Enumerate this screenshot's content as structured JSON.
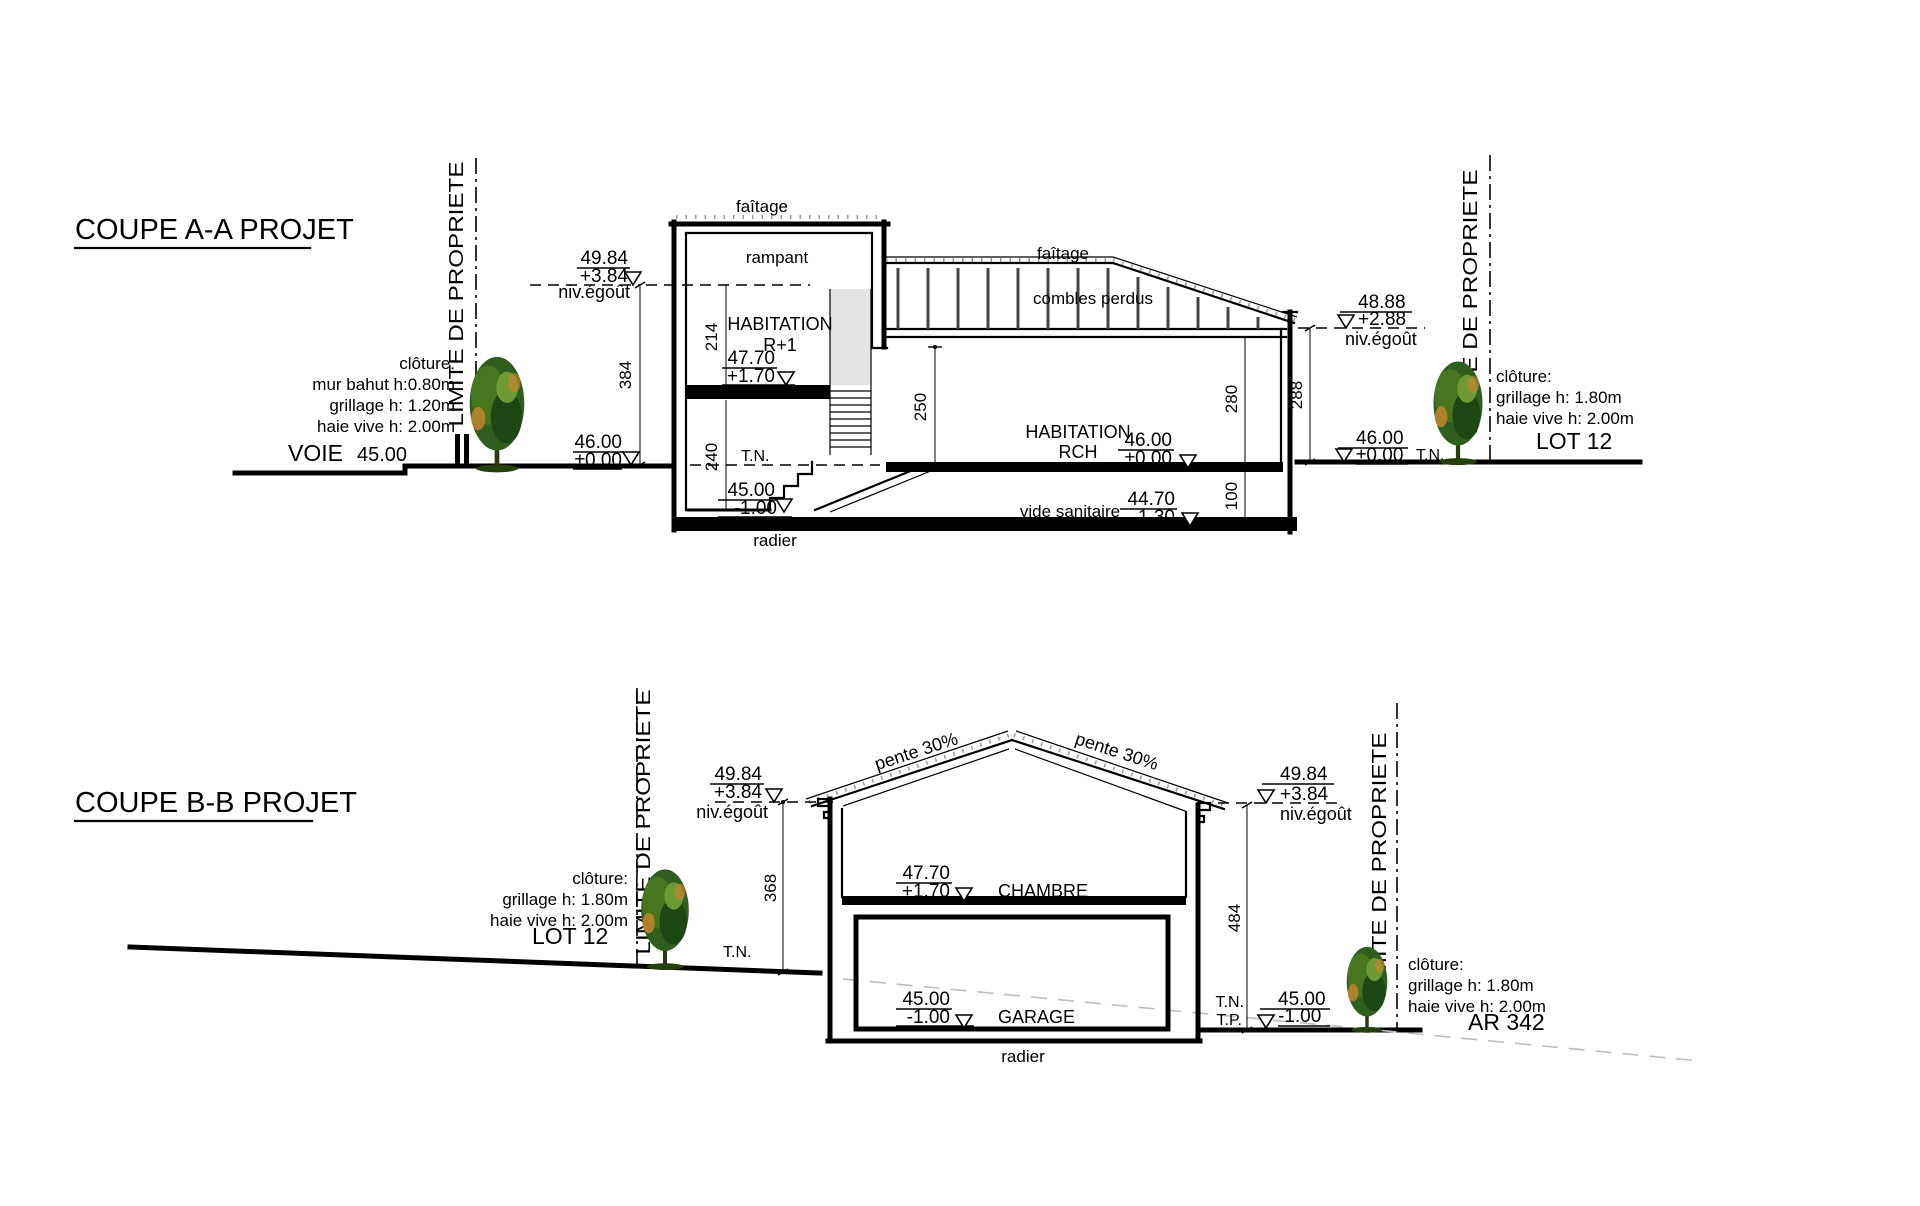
{
  "coupe_a": {
    "title": "COUPE A-A PROJET",
    "limite_left": "LIMITE DE PROPRIETE",
    "limite_right": "LIMITE DE PROPRIETE",
    "cloture_left": {
      "l1": "clôture:",
      "l2": "mur bahut h:0.80m",
      "l3": "grillage h: 1.20m",
      "l4": "haie vive h: 2.00m"
    },
    "cloture_right": {
      "l1": "clôture:",
      "l2": "grillage h: 1.80m",
      "l3": "haie vive h: 2.00m"
    },
    "voie": "VOIE",
    "voie_level": "45.00",
    "lot": "LOT 12",
    "faitage_left": "faîtage",
    "rampant": "rampant",
    "habitation_r1_line1": "HABITATION",
    "habitation_r1_line2": "R+1",
    "faitage_right": "faîtage",
    "combles": "combles perdus",
    "habitation_rch_line1": "HABITATION",
    "habitation_rch_line2": "RCH",
    "vide_sanitaire": "vide sanitaire",
    "radier": "radier",
    "tn_left": "T.N.",
    "tn_right": "T.N.",
    "niv_egout_left": "niv.égoût",
    "niv_egout_right": "niv.égoût",
    "levels": {
      "left_eave": {
        "a": "49.84",
        "b": "+3.84"
      },
      "left_ground": {
        "a": "46.00",
        "b": "±0.00"
      },
      "floor_r1": {
        "a": "47.70",
        "b": "+1.70"
      },
      "basement": {
        "a": "45.00",
        "b": "-1.00"
      },
      "rch": {
        "a": "46.00",
        "b": "±0.00"
      },
      "vide": {
        "a": "44.70",
        "b": "-1.30"
      },
      "right_eave": {
        "a": "48.88",
        "b": "+2.88"
      },
      "right_ground": {
        "a": "46.00",
        "b": "±0.00"
      }
    },
    "dims": {
      "d384": "384",
      "d214": "214",
      "d240": "240",
      "d250": "250",
      "d280": "280",
      "d288": "288",
      "d100": "100"
    }
  },
  "coupe_b": {
    "title": "COUPE B-B PROJET",
    "limite_left": "LIMITE DE PROPRIETE",
    "limite_right": "LIMITE DE PROPRIETE",
    "cloture_left": {
      "l1": "clôture:",
      "l2": "grillage h: 1.80m",
      "l3": "haie vive h: 2.00m"
    },
    "cloture_right": {
      "l1": "clôture:",
      "l2": "grillage h: 1.80m",
      "l3": "haie vive h: 2.00m"
    },
    "lot": "LOT 12",
    "ar": "AR 342",
    "pente_left": "pente 30%",
    "pente_right": "pente 30%",
    "chambre": "CHAMBRE",
    "garage": "GARAGE",
    "radier": "radier",
    "tn_left": "T.N.",
    "tn_right": "T.N.",
    "tp_right": "T.P.",
    "niv_egout_left": "niv.égoût",
    "niv_egout_right": "niv.égoût",
    "levels": {
      "left_eave": {
        "a": "49.84",
        "b": "+3.84"
      },
      "right_eave": {
        "a": "49.84",
        "b": "+3.84"
      },
      "chambre_floor": {
        "a": "47.70",
        "b": "+1.70"
      },
      "garage_floor": {
        "a": "45.00",
        "b": "-1.00"
      },
      "right_ground": {
        "a": "45.00",
        "b": "-1.00"
      }
    },
    "dims": {
      "d368": "368",
      "d484": "484"
    }
  }
}
